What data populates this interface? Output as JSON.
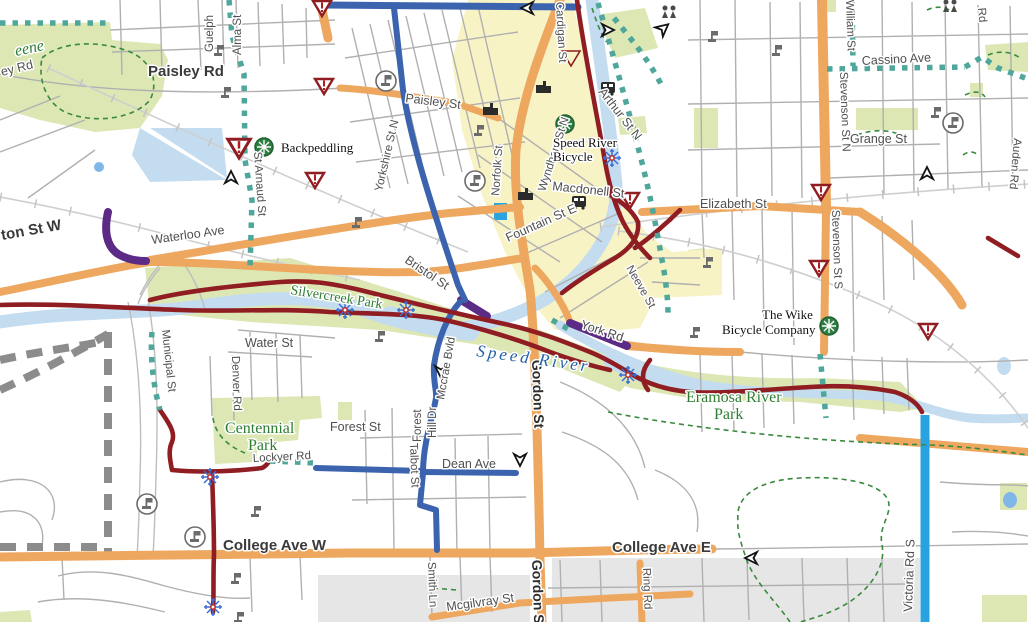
{
  "labels": {
    "streets": [
      "Paisley Rd",
      "ey Rd",
      "Guelph",
      "Alma St",
      "Paisley St",
      "Yorkshire St N",
      "Norfolk St",
      "Wyndham St N",
      "Macdonell St",
      "Cardigan St",
      "Arthur St N",
      "Elizabeth St",
      "Stevenson St N",
      "William St",
      "Cassino Ave",
      "Grange St",
      "Auden Rd",
      "Rd",
      "Waterloo Ave",
      "ton St W",
      "Bristol St",
      "Fountain St E",
      "Neeve St",
      "York Rd",
      "Water St",
      "Municipal St",
      "Denver Rd",
      "St Arnaud St",
      "Stevenson St S",
      "Lockyer Rd",
      "Forest St",
      "Dean Ave",
      "College Ave W",
      "College Ave E",
      "Talbot St",
      "Forest",
      "Hill Dr",
      "Smith Ln",
      "Mcgilvray St",
      "Ring Rd",
      "Victoria Rd S",
      "Gordon St",
      "Gordon St",
      "Mccrae Bvld"
    ],
    "parks": [
      "eene",
      "Silvercreek Park",
      "Centennial",
      "Park",
      "Eramosa River",
      "Park"
    ],
    "water": [
      "Speed River"
    ],
    "pois": [
      "Backpeddling",
      "Speed River",
      "Bicycle",
      "The Wike",
      "Bicycle Company"
    ]
  },
  "icons": [
    "bike-shop-wheel-icon",
    "warning-triangle-icon",
    "snowflake-icon",
    "flag-icon",
    "circled-flag-icon",
    "direction-arrow-icon",
    "people-icon",
    "bus-icon",
    "building-icon"
  ],
  "colors": {
    "major_road_orange": "#EDA75F",
    "bike_lane_blue": "#3C63AE",
    "signed_route_cyan": "#29A3DF",
    "trail_dark_red": "#8F1D22",
    "route_purple": "#5C2B86",
    "proposed_teal": "#4FA79B",
    "park_green_fill": "#DCE7B4",
    "downtown_yellow_fill": "#F8F3C5",
    "water_blue": "#C4DCF0",
    "pond_bright_blue": "#2AA5DF",
    "campus_gray_fill": "#E6E6E6",
    "minor_road_gray": "#B0B0B0",
    "label_green": "#2E7D32",
    "label_blue": "#2460A7"
  }
}
